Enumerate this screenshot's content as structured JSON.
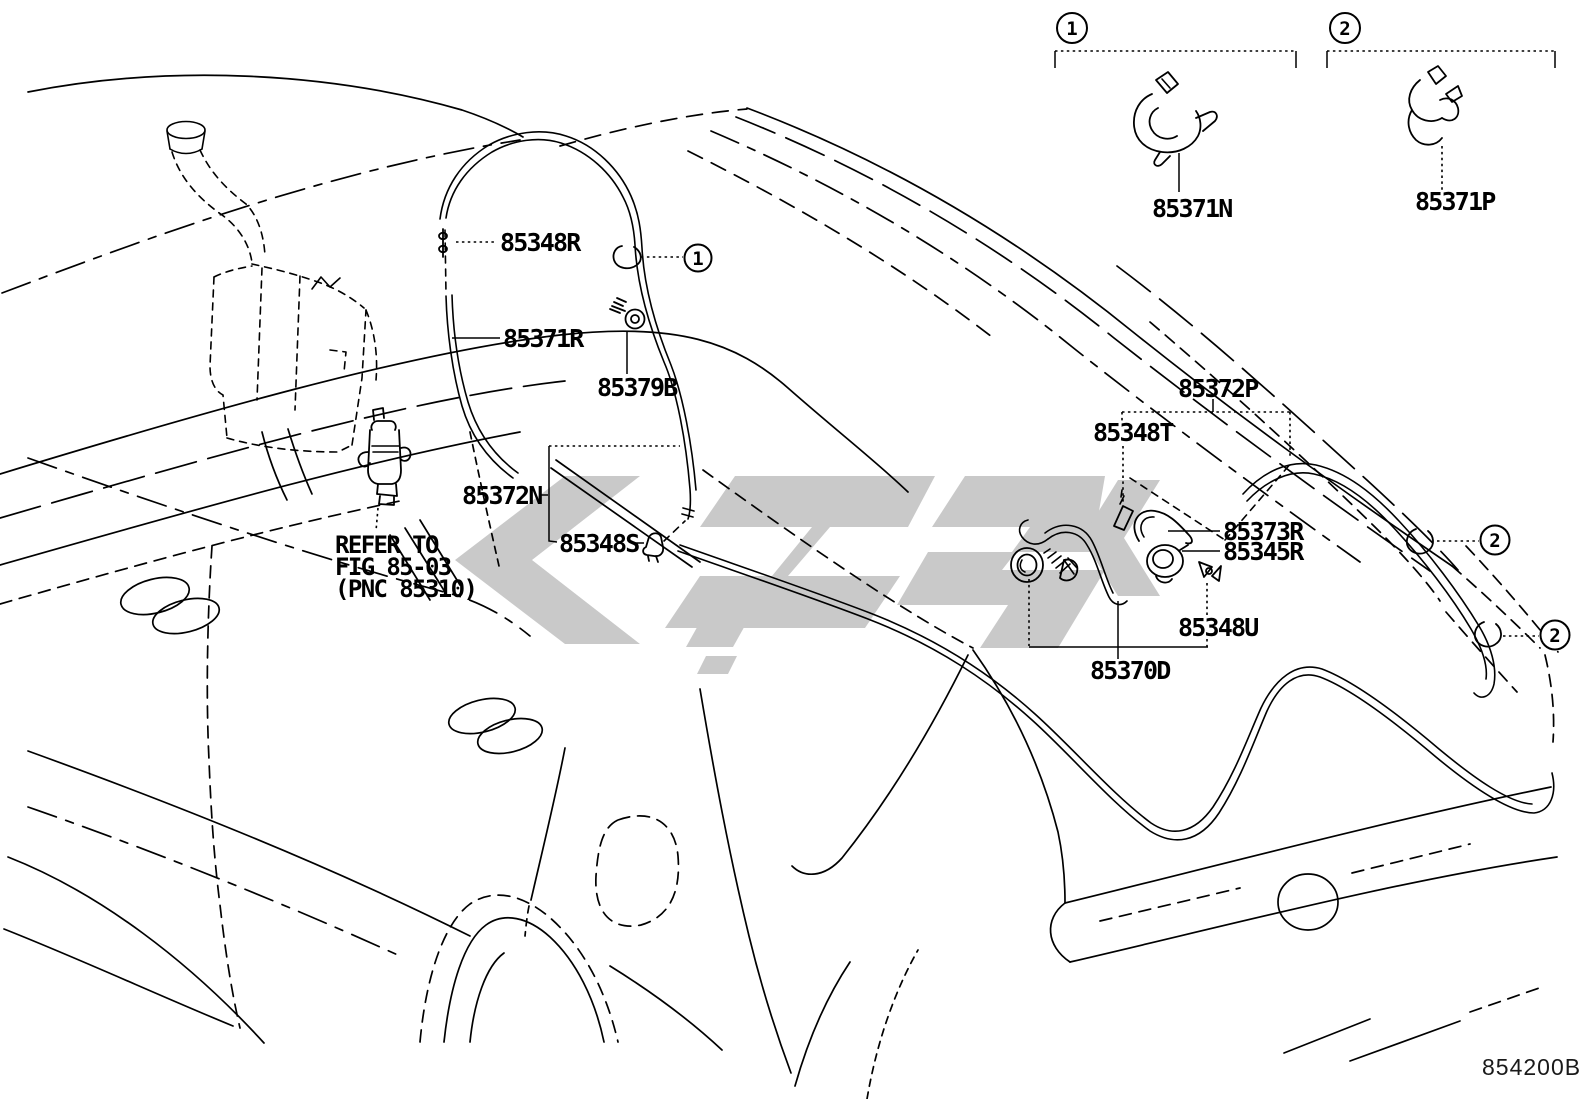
{
  "diagram": {
    "code": "854200B",
    "note": {
      "line1": "REFER TO",
      "line2": "FIG 85-03",
      "line3": "(PNC 85310)"
    },
    "callouts": {
      "clip_type_1": "1",
      "clip_type_2": "2"
    },
    "parts": [
      {
        "label": "85348R"
      },
      {
        "label": "85371R"
      },
      {
        "label": "85379B"
      },
      {
        "label": "85372N"
      },
      {
        "label": "85348S"
      },
      {
        "label": "85372P"
      },
      {
        "label": "85348T"
      },
      {
        "label": "85373R"
      },
      {
        "label": "85345R"
      },
      {
        "label": "85348U"
      },
      {
        "label": "85370D"
      },
      {
        "label": "85371N"
      },
      {
        "label": "85371P"
      }
    ],
    "colors": {
      "line": "#000000",
      "watermark": "#c9c9c9",
      "background": "#ffffff"
    }
  }
}
